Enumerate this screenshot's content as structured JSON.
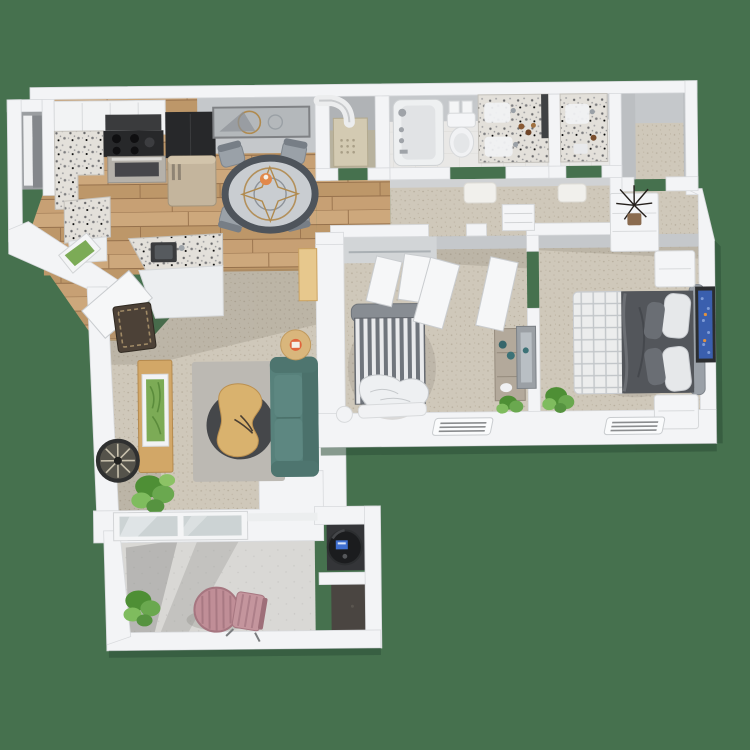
{
  "scene": {
    "type": "3d-floor-plan-render",
    "description": "Top-down 3D rendering of a two-bedroom, two-bath apartment with kitchen, dining area, living room, walk-in closet, private patio and exterior storage closets",
    "background": "#46714E"
  },
  "palette": {
    "background": "#46714E",
    "wall": "#f3f4f6",
    "wallShade": "#c5c8cb",
    "wallFace": "#b4b7ba",
    "wood": "#c39e73",
    "woodDark": "#a9845c",
    "carpet": "#cfc8ba",
    "carpetDot": "#b5ac9b",
    "tile": "#e9e8e6",
    "concrete": "#d9d8d5",
    "granite": "#e3e0da",
    "graniteSpeck": "#5f5f61",
    "sofa": "#57817b",
    "sofaDark": "#4b716b",
    "woodFurniture": "#d5ad6e",
    "rug": "#bcb9b3",
    "rugRound": "#45474a",
    "duvet": "#53565b",
    "bedStripe": "#70757c",
    "linen": "#eceded",
    "blueArt": "#3a5fae",
    "plant": "#6aa84f",
    "plantDark": "#4e8f35",
    "applianceBlack": "#27282a",
    "fridgeSteel": "#c4b59d",
    "furnaceBeige": "#d3cab2",
    "heaterBlack": "#1b1c1e",
    "closetDark": "#343538",
    "bistroPink": "#c08e97",
    "matBrown": "#4c4137"
  },
  "rooms": [
    {
      "id": "entry",
      "furniture": [
        "coat-closet",
        "console-table",
        "framed-greenery-art",
        "welcome-mat",
        "entry-door"
      ]
    },
    {
      "id": "kitchen",
      "furniture": [
        "upper-cabinets",
        "range-oven",
        "range-hood",
        "black-pantry-cabinet",
        "refrigerator",
        "granite-counter",
        "island-with-sink"
      ]
    },
    {
      "id": "dining",
      "furniture": [
        "round-mandala-table",
        "four-gray-chairs",
        "wall-mirror-art",
        "orange-centerpiece"
      ]
    },
    {
      "id": "mechanical-closet",
      "furniture": [
        "furnace-water-heater",
        "vent-duct"
      ]
    },
    {
      "id": "bathroom-1",
      "furniture": [
        "bathtub",
        "toilet",
        "towel-bar",
        "granite-vanity",
        "bath-mat"
      ]
    },
    {
      "id": "bathroom-2",
      "furniture": [
        "granite-vanity",
        "bath-mat"
      ]
    },
    {
      "id": "walk-in-closet",
      "furniture": []
    },
    {
      "id": "hallway",
      "furniture": [
        "linen-shelf",
        "doors"
      ]
    },
    {
      "id": "bedroom-2",
      "furniture": [
        "striped-bed",
        "closet-double-doors",
        "dresser",
        "leaning-mirror",
        "plant"
      ]
    },
    {
      "id": "primary-bedroom",
      "furniture": [
        "bed-dark-duvet-plaid-throw",
        "two-nightstands",
        "blue-wall-art",
        "white-dresser-with-twig-plant",
        "plant"
      ]
    },
    {
      "id": "living-room",
      "furniture": [
        "teal-sofa",
        "kidney-coffee-table",
        "round-dark-rug",
        "gray-area-rug",
        "media-console",
        "green-art",
        "wall-clock",
        "side-table-with-candle",
        "floor-plant",
        "wood-desk",
        "sliding-glass-door"
      ]
    },
    {
      "id": "patio",
      "furniture": [
        "pink-bistro-table",
        "pink-slat-chair",
        "two-plants"
      ]
    },
    {
      "id": "storage-closets",
      "furniture": [
        "round-water-heater"
      ]
    }
  ],
  "floors": {
    "kitchen_dining": "hardwood",
    "bathrooms": "tile",
    "living_bedrooms_hall_closets": "carpet",
    "patio": "concrete"
  },
  "fixtures": [
    "floor-vent-bedroom-2",
    "floor-vent-primary-bedroom"
  ]
}
